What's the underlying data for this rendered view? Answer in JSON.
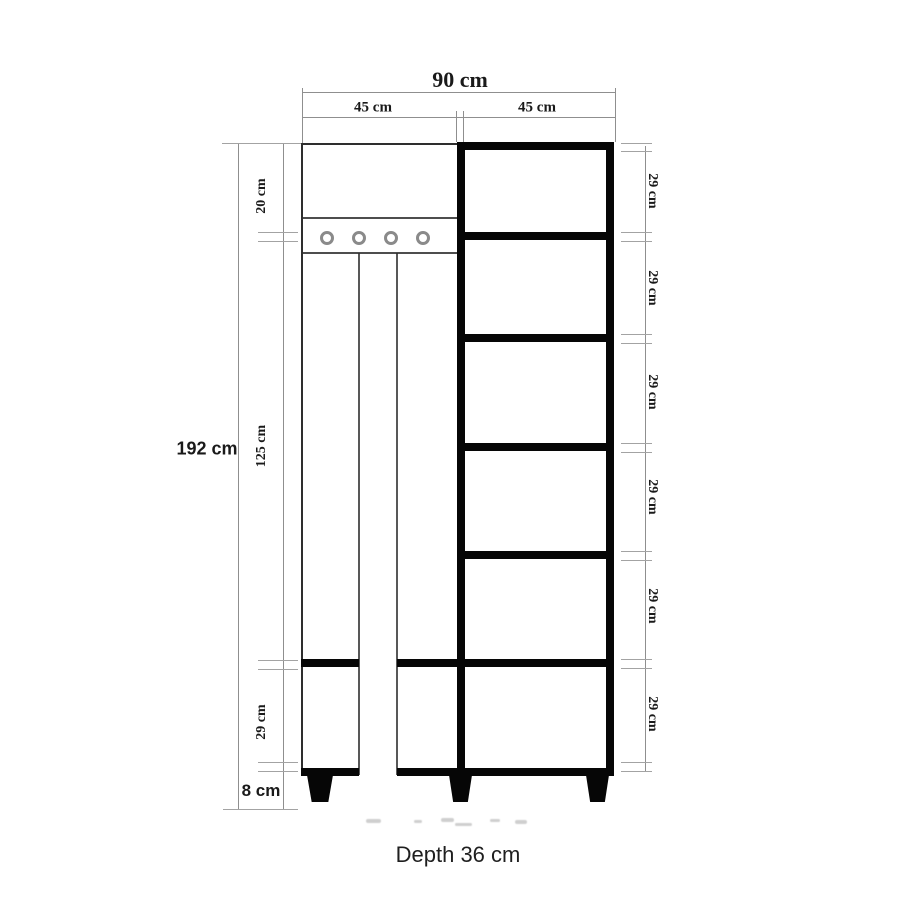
{
  "palette": {
    "dimension_line": "#8f8f8f",
    "cabinet_outline": "#2e2e2e",
    "cabinet_solid": "#060606",
    "text": "#1a1a1a"
  },
  "dimensions": {
    "top": {
      "total_width": "90 cm",
      "left_half": "45 cm",
      "right_half": "45 cm"
    },
    "left": {
      "total_height": "192 cm",
      "top_section": "20 cm",
      "middle_section": "125 cm",
      "bottom_section": "29 cm",
      "leg_height": "8 cm"
    },
    "right": {
      "shelf_sections": [
        "29 cm",
        "29 cm",
        "29 cm",
        "29 cm",
        "29 cm",
        "29 cm"
      ]
    }
  },
  "structure": {
    "hook_count": 4,
    "shelf_count": 6,
    "leg_count": 3
  },
  "footer": {
    "depth_note": "Depth 36 cm"
  }
}
